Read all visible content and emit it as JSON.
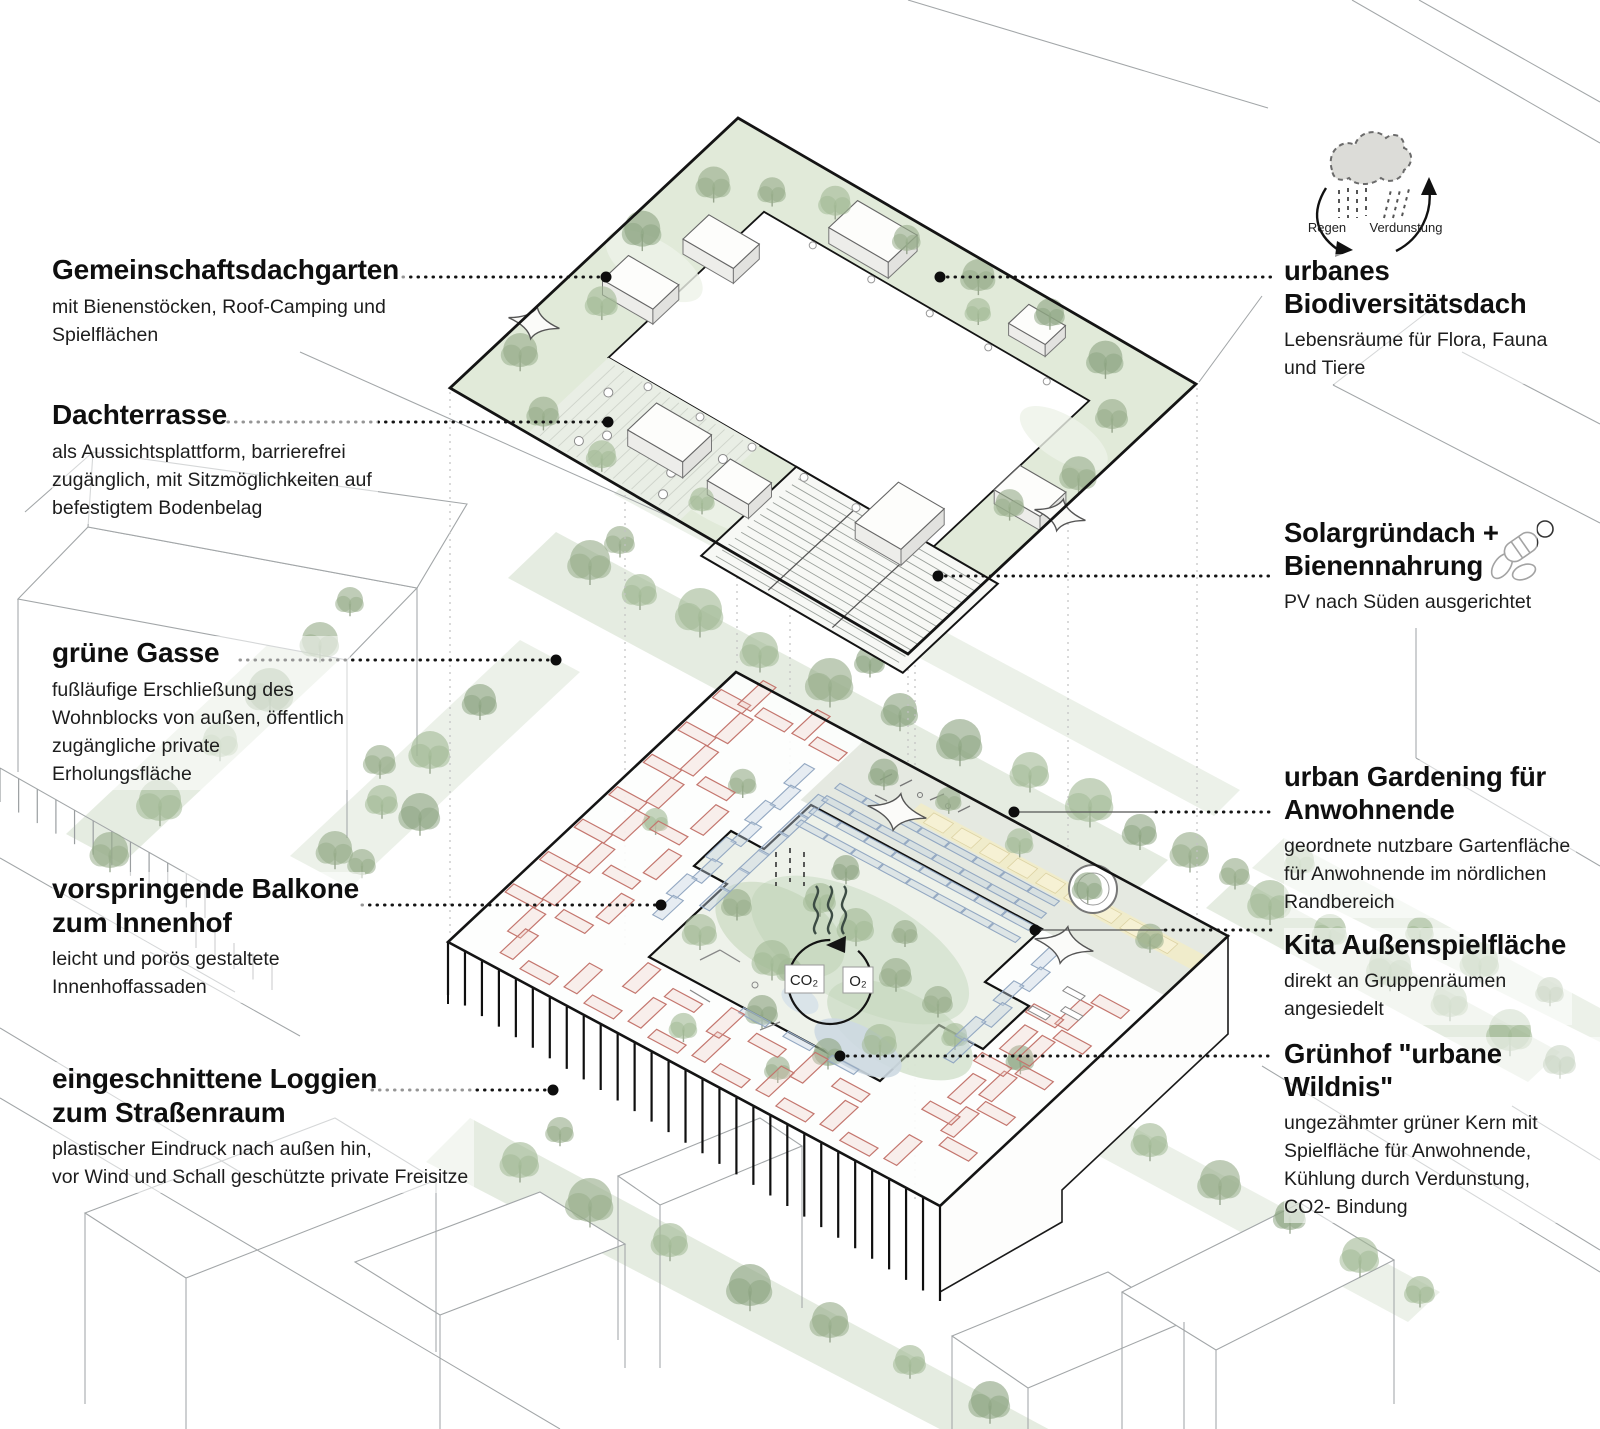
{
  "diagram_title": "Wohnblock Nachhaltigkeits-Axonometrie",
  "annotations_left": [
    {
      "title": "Gemeinschaftsdachgarten",
      "description": "mit Bienenstöcken, Roof-Camping und\nSpielflächen"
    },
    {
      "title": "Dachterrasse",
      "description": "als Aussichtsplattform, barrierefrei\nzugänglich, mit Sitzmöglichkeiten auf\nbefestigtem Bodenbelag"
    },
    {
      "title": "grüne Gasse",
      "description": "fußläufige Erschließung des\nWohnblocks von außen, öffentlich\nzugängliche private\nErholungsfläche"
    },
    {
      "title": "vorspringende Balkone\nzum Innenhof",
      "description": "leicht und porös gestaltete\nInnenhoffassaden"
    },
    {
      "title": "eingeschnittene Loggien\nzum Straßenraum",
      "description": "plastischer Eindruck nach außen hin,\nvor Wind und Schall geschützte private Freisitze"
    }
  ],
  "annotations_right": [
    {
      "title": "urbanes\nBiodiversitätsdach",
      "description": "Lebensräume für Flora, Fauna\nund Tiere"
    },
    {
      "title": "Solargründach +\nBienennahrung",
      "description": "PV nach Süden ausgerichtet"
    },
    {
      "title": "urban Gardening für\nAnwohnende",
      "description": "geordnete nutzbare Gartenfläche\nfür Anwohnende im nördlichen\nRandbereich"
    },
    {
      "title": "Kita Außenspielfläche",
      "description": "direkt an Gruppenräumen\nangesiedelt"
    },
    {
      "title": "Grünhof \"urbane Wildnis\"",
      "description": "ungezähmter grüner Kern mit\nSpielfläche für Anwohnende,\nKühlung durch Verdunstung,\nCO2- Bindung"
    }
  ],
  "water_cycle": {
    "rain_label": "Regen",
    "evaporation_label": "Verdunstung"
  },
  "gas_exchange": {
    "co2_label": "CO₂",
    "o2_label": "O₂"
  },
  "colors": {
    "tree_green": "#8ea583",
    "light_green_band": "#e1ead9",
    "loggia_red": "#c4766e",
    "balcony_blue": "#93a8c2",
    "path_yellow": "#f1ecc9",
    "outline_black": "#141414"
  }
}
